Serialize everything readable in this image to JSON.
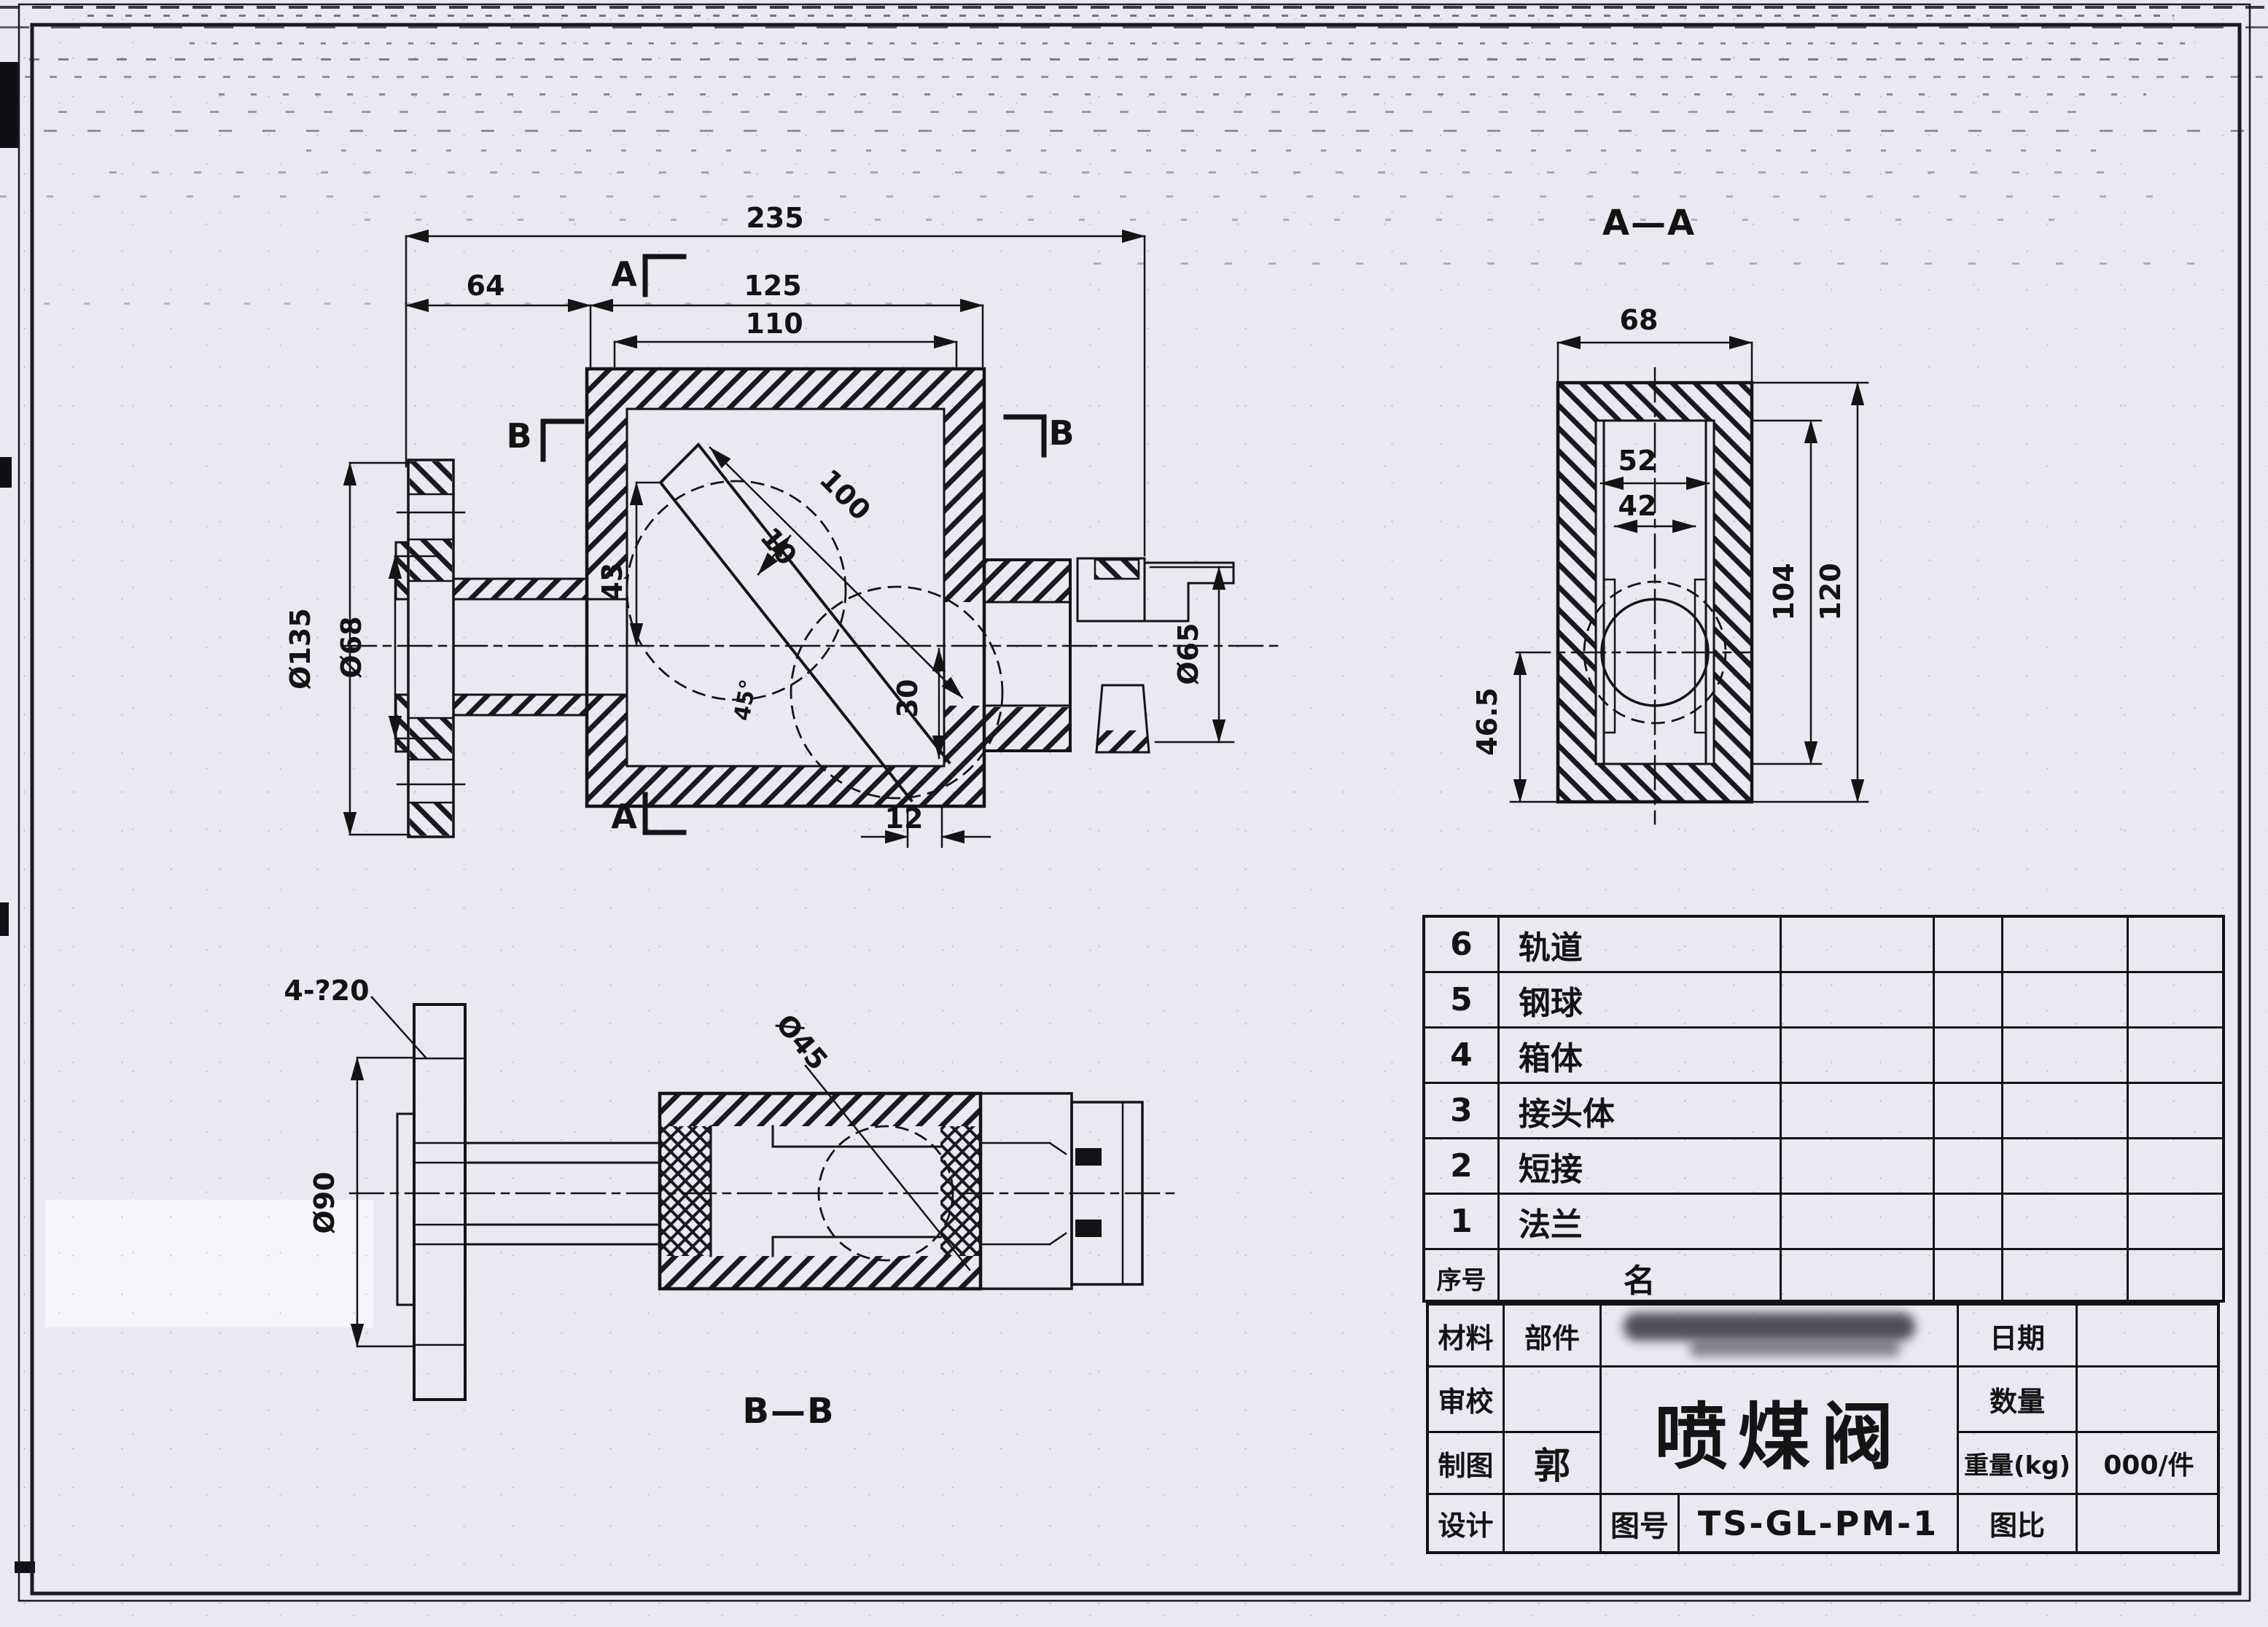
{
  "drawing": {
    "front": {
      "dim_235": "235",
      "dim_64": "64",
      "dim_125": "125",
      "dim_110": "110",
      "dim_100": "100",
      "dim_10": "10",
      "dim_43": "43",
      "dim_30": "30",
      "dim_12": "12",
      "angle": "45°",
      "dia_135": "Ø135",
      "dia_68": "Ø68",
      "dia_65": "Ø65",
      "sec_a": "A",
      "sec_b": "B"
    },
    "aa": {
      "title": "A—A",
      "dim_68": "68",
      "dim_52": "52",
      "dim_42": "42",
      "dim_104": "104",
      "dim_120": "120",
      "dim_46_5": "46.5"
    },
    "bb": {
      "title": "B—B",
      "holes": "4-?20",
      "dia_90": "Ø90",
      "dia_45": "Ø45"
    }
  },
  "parts_table": {
    "header": {
      "no": "序号",
      "name": "名"
    },
    "rows": [
      {
        "no": "6",
        "name": "轨道"
      },
      {
        "no": "5",
        "name": "钢球"
      },
      {
        "no": "4",
        "name": "箱体"
      },
      {
        "no": "3",
        "name": "接头体"
      },
      {
        "no": "2",
        "name": "短接"
      },
      {
        "no": "1",
        "name": "法兰"
      }
    ]
  },
  "title_block": {
    "material_label": "材料",
    "part_label": "部件",
    "check_label": "审校",
    "draft_label": "制图",
    "draftsman": "郭",
    "design_label": "设计",
    "product_title": "喷煤阀",
    "date_label": "日期",
    "qty_label": "数量",
    "weight_label": "重量(kg)",
    "weight_value": "000/件",
    "drawing_no_label": "图号",
    "drawing_no": "TS-GL-PM-1",
    "scale_label": "图比"
  }
}
